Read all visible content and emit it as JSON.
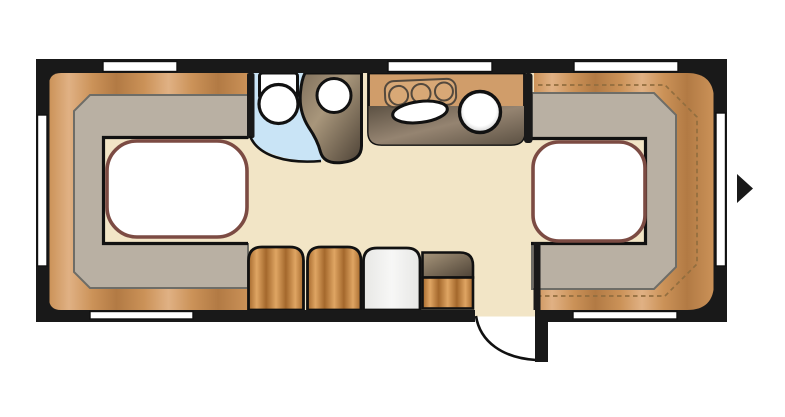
{
  "canvas": {
    "width": 785,
    "height": 417
  },
  "colors": {
    "wall": "#191919",
    "floor": "#f2e5c6",
    "wood_light": "#e0b184",
    "wood_mid": "#cb9258",
    "wood_dark": "#b27a44",
    "surround_gray": "#b9b0a3",
    "surround_border": "#6e6d67",
    "bed_outline": "#7c4b43",
    "bed_white": "#ffffff",
    "bath_blue": "#c9e4f6",
    "cab_light": "#a8967b",
    "cab_mid": "#80705c",
    "cab_dark": "#4d4236",
    "counter_tan": "#d09d6a",
    "shadow_light": "#958471",
    "shadow_dark": "#5c5143",
    "stove_tan": "#d8a876",
    "stove_line": "#54493d",
    "sink_white": "#ffffff",
    "basin_rim": "#c2c2c2",
    "cushion_dark": "#a4682c",
    "cushion_light": "#dfa563",
    "cushion_pale": "#f3f3f1",
    "dash": "#926e3f",
    "window_white": "#ffffff",
    "outline": "#111111"
  },
  "icons": {
    "direction_arrow": "right-pointing-triangle"
  }
}
